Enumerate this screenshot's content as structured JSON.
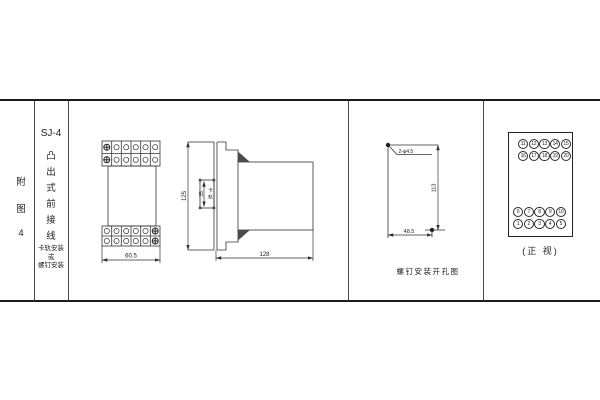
{
  "sheet": {
    "figure_chars": [
      "附",
      "图",
      "4"
    ],
    "model": "SJ-4",
    "model_desc_chars": [
      "凸",
      "出",
      "式",
      "前",
      "接",
      "线"
    ],
    "mounting_lines": [
      "卡轨安装",
      "或",
      "螺钉安装"
    ]
  },
  "front_view": {
    "width_dim": "60.5"
  },
  "side_view": {
    "height_dim": "125",
    "rail_width_dim": "35",
    "rail_label_chars": [
      "卡",
      "轨"
    ],
    "depth_dim": "128"
  },
  "drill_view": {
    "holes_label": "2-φ4.5",
    "height_dim": "113",
    "width_dim": "48.5",
    "caption": "螺钉安装开孔图"
  },
  "terminal_view": {
    "rows": [
      [
        "11",
        "12",
        "13",
        "14",
        "15"
      ],
      [
        "16",
        "17",
        "18",
        "19",
        "20"
      ],
      [
        "6",
        "7",
        "8",
        "9",
        "10"
      ],
      [
        "1",
        "2",
        "3",
        "4",
        "5"
      ]
    ],
    "caption": "(正 视)"
  },
  "colors": {
    "ink": "#222222",
    "line": "#333333",
    "paper": "#ffffff"
  }
}
